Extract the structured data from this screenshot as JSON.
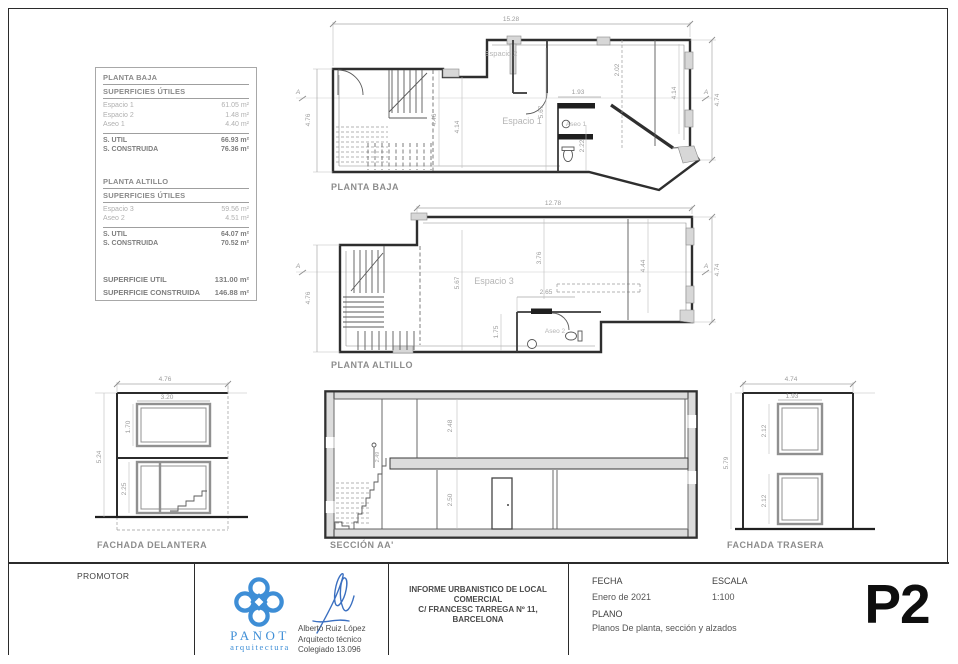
{
  "areas_table": {
    "baja": {
      "title": "PLANTA BAJA",
      "subtitle": "SUPERFICIES ÚTILES",
      "rows": [
        {
          "label": "Espacio 1",
          "value": "61.05 m²"
        },
        {
          "label": "Espacio 2",
          "value": "1.48 m²"
        },
        {
          "label": "Aseo 1",
          "value": "4.40 m²"
        }
      ],
      "totals": [
        {
          "label": "S. UTIL",
          "value": "66.93 m²"
        },
        {
          "label": "S. CONSTRUIDA",
          "value": "76.36 m²"
        }
      ]
    },
    "altillo": {
      "title": "PLANTA ALTILLO",
      "subtitle": "SUPERFICIES ÚTILES",
      "rows": [
        {
          "label": "Espacio 3",
          "value": "59.56 m²"
        },
        {
          "label": "Aseo 2",
          "value": "4.51 m²"
        }
      ],
      "totals": [
        {
          "label": "S. UTIL",
          "value": "64.07 m²"
        },
        {
          "label": "S. CONSTRUIDA",
          "value": "70.52 m²"
        }
      ]
    },
    "grand": [
      {
        "label": "SUPERFICIE UTIL",
        "value": "131.00 m²"
      },
      {
        "label": "SUPERFICIE CONSTRUIDA",
        "value": "146.88 m²"
      }
    ]
  },
  "planta_baja": {
    "title": "PLANTA BAJA",
    "rooms": {
      "espacio1": "Espacio 1",
      "espacio2": "Espacio 2",
      "aseo1": "Aseo 1"
    },
    "dims": {
      "top": "15.28",
      "left": "4.76",
      "right": "4.74",
      "right_inner": "4.14",
      "closet": "2.02",
      "aseo_w": "1.93",
      "mid": "5.67",
      "room_a": "4.46",
      "room_b": "4.14",
      "aseo_h": "2.22"
    },
    "section_marker": "A"
  },
  "planta_altillo": {
    "title": "PLANTA ALTILLO",
    "rooms": {
      "espacio3": "Espacio 3",
      "aseo2": "Aseo 2"
    },
    "dims": {
      "top": "12.78",
      "left": "4.76",
      "right": "4.74",
      "right_inner": "4.44",
      "mid": "3.76",
      "left_mid": "5.67",
      "aseo_w": "2.65",
      "aseo_h": "1.75"
    },
    "section_marker": "A"
  },
  "fachada_delantera": {
    "title": "FACHADA DELANTERA",
    "dims": {
      "width": "4.76",
      "window_w": "3.20",
      "window_h": "1.70",
      "height": "5.24",
      "door_h": "2.25"
    }
  },
  "seccion": {
    "title": "SECCIÓN AA'",
    "dims": {
      "upper": "2.48",
      "lower": "2.50",
      "stair": "2.49"
    }
  },
  "fachada_trasera": {
    "title": "FACHADA TRASERA",
    "dims": {
      "width": "4.74",
      "window_w": "1.93",
      "window1_h": "2.12",
      "window2_h": "2.12",
      "height": "5.79"
    }
  },
  "title_block": {
    "promotor_label": "PROMOTOR",
    "logo": {
      "name": "PANOT",
      "subtitle": "arquitectura",
      "color": "#3e8ed6"
    },
    "architect": {
      "name": "Alberto Ruiz López",
      "role": "Arquitecto técnico",
      "license": "Colegiado 13.096"
    },
    "project": {
      "line1": "INFORME URBANISTICO DE LOCAL",
      "line2": "COMERCIAL",
      "line3": "C/ FRANCESC TARREGA Nº 11,",
      "line4": "BARCELONA"
    },
    "fecha_label": "FECHA",
    "fecha_value": "Enero de 2021",
    "escala_label": "ESCALA",
    "escala_value": "1:100",
    "plano_label": "PLANO",
    "plano_value": "Planos De planta, sección y alzados",
    "sheet_number": "P2"
  }
}
